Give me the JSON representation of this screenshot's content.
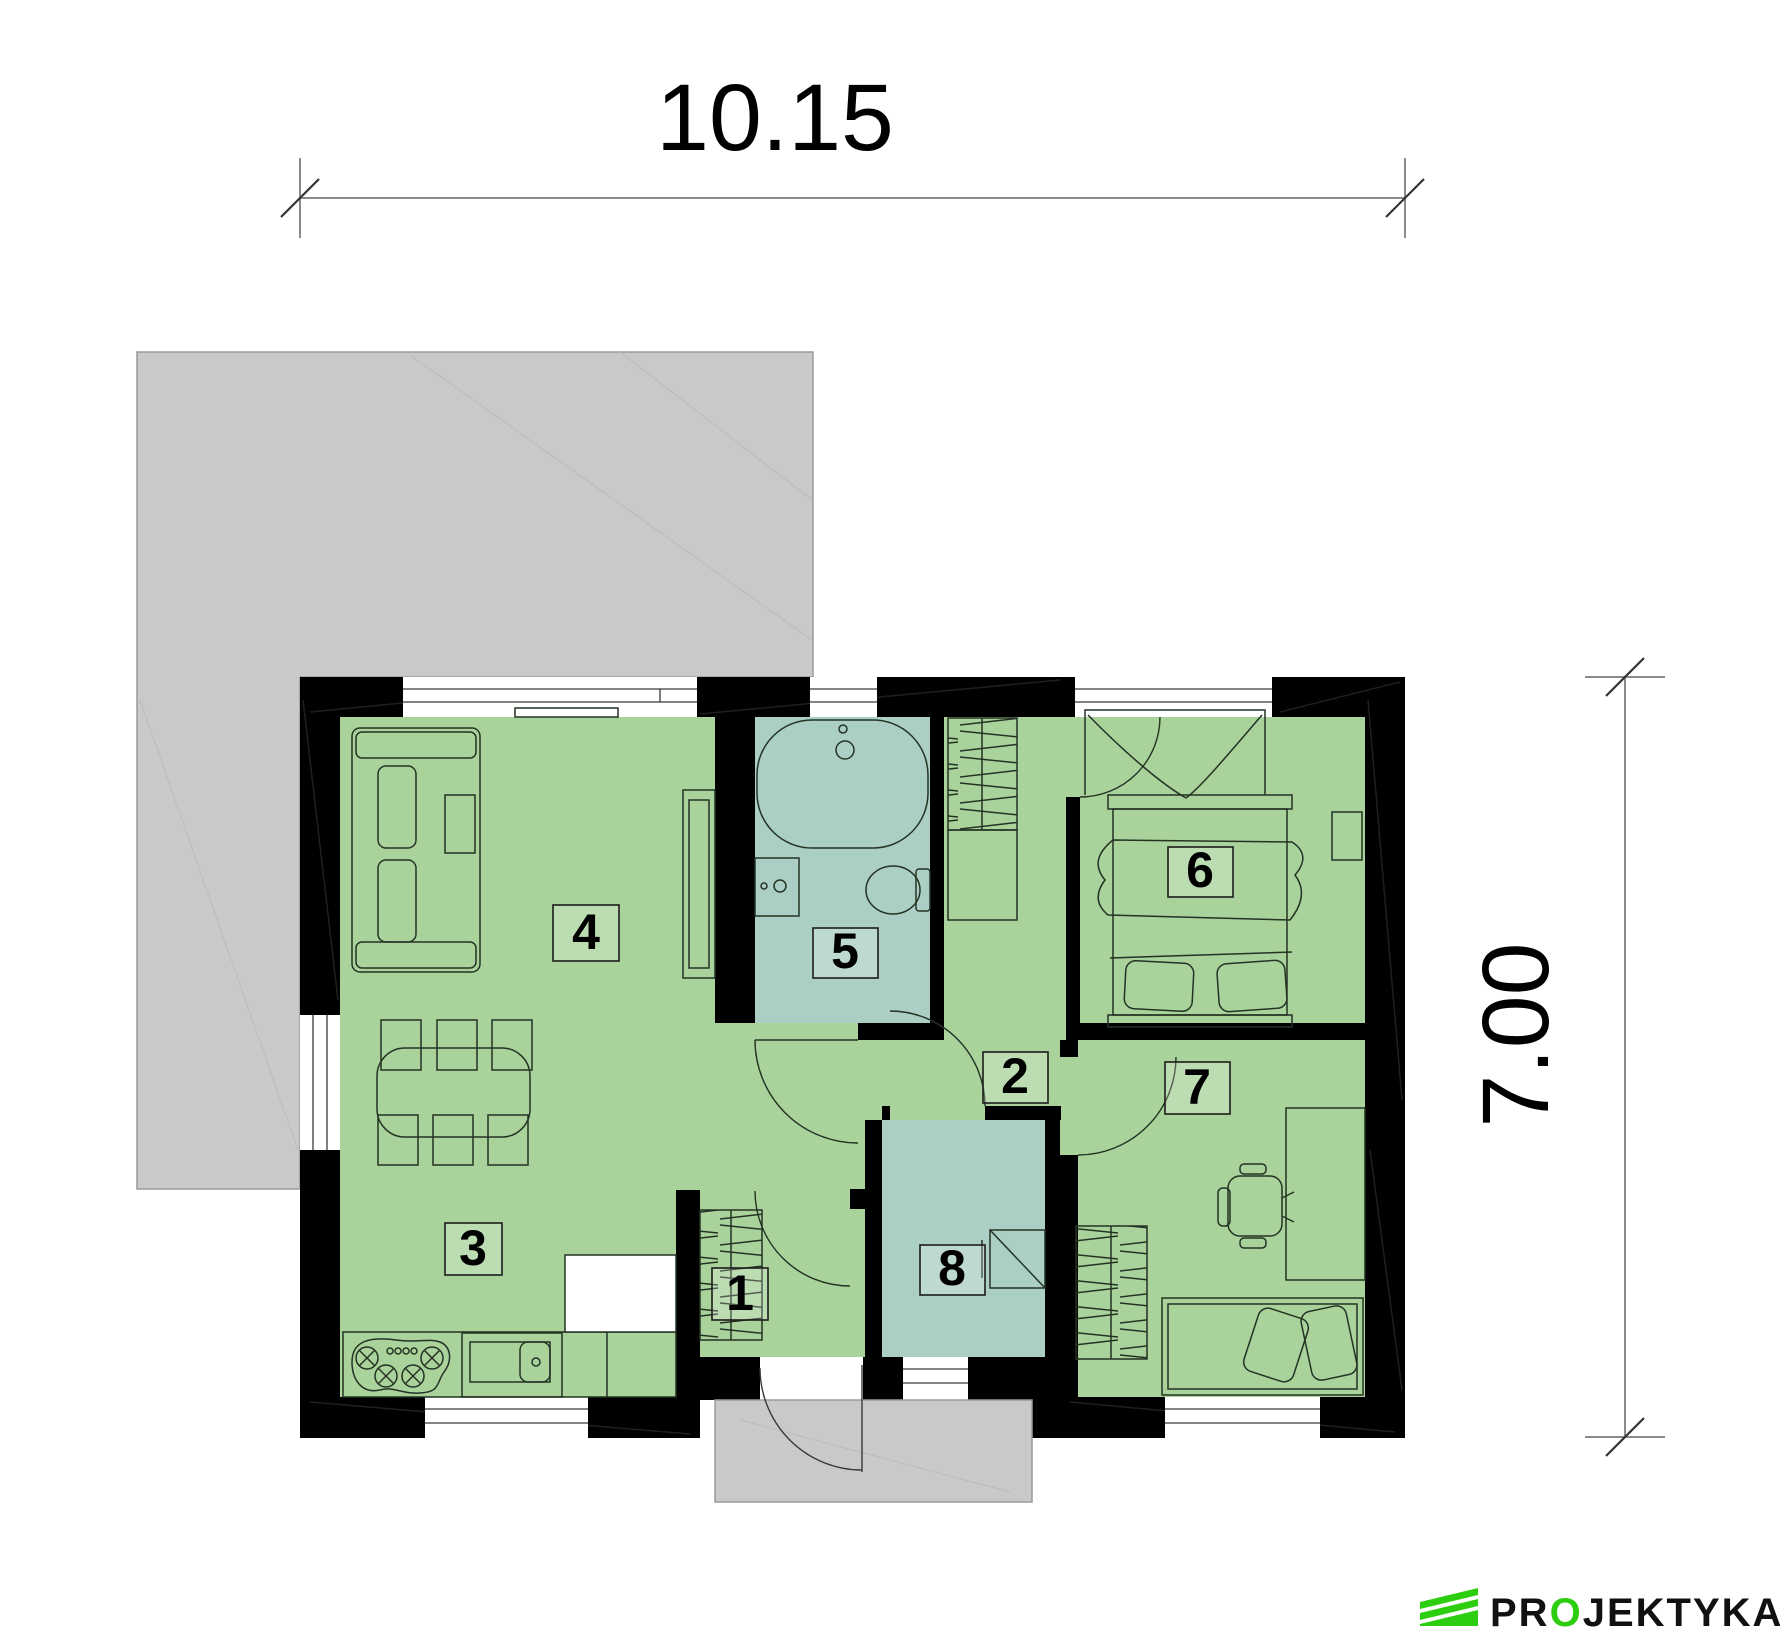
{
  "dimensions": {
    "width_label": "10.15",
    "height_label": "7.00"
  },
  "rooms": [
    {
      "number": "1"
    },
    {
      "number": "2"
    },
    {
      "number": "3"
    },
    {
      "number": "4"
    },
    {
      "number": "5"
    },
    {
      "number": "6"
    },
    {
      "number": "7"
    },
    {
      "number": "8"
    }
  ],
  "logo": {
    "pre": "PR",
    "o": "O",
    "rest": "JEKTYKA"
  },
  "colors": {
    "floor_green": "#AAD29B",
    "floor_teal": "#ABCFC4",
    "wall_black": "#000000",
    "terrace_gray": "#C9C9C9",
    "logo_green": "#2DCE0F"
  }
}
